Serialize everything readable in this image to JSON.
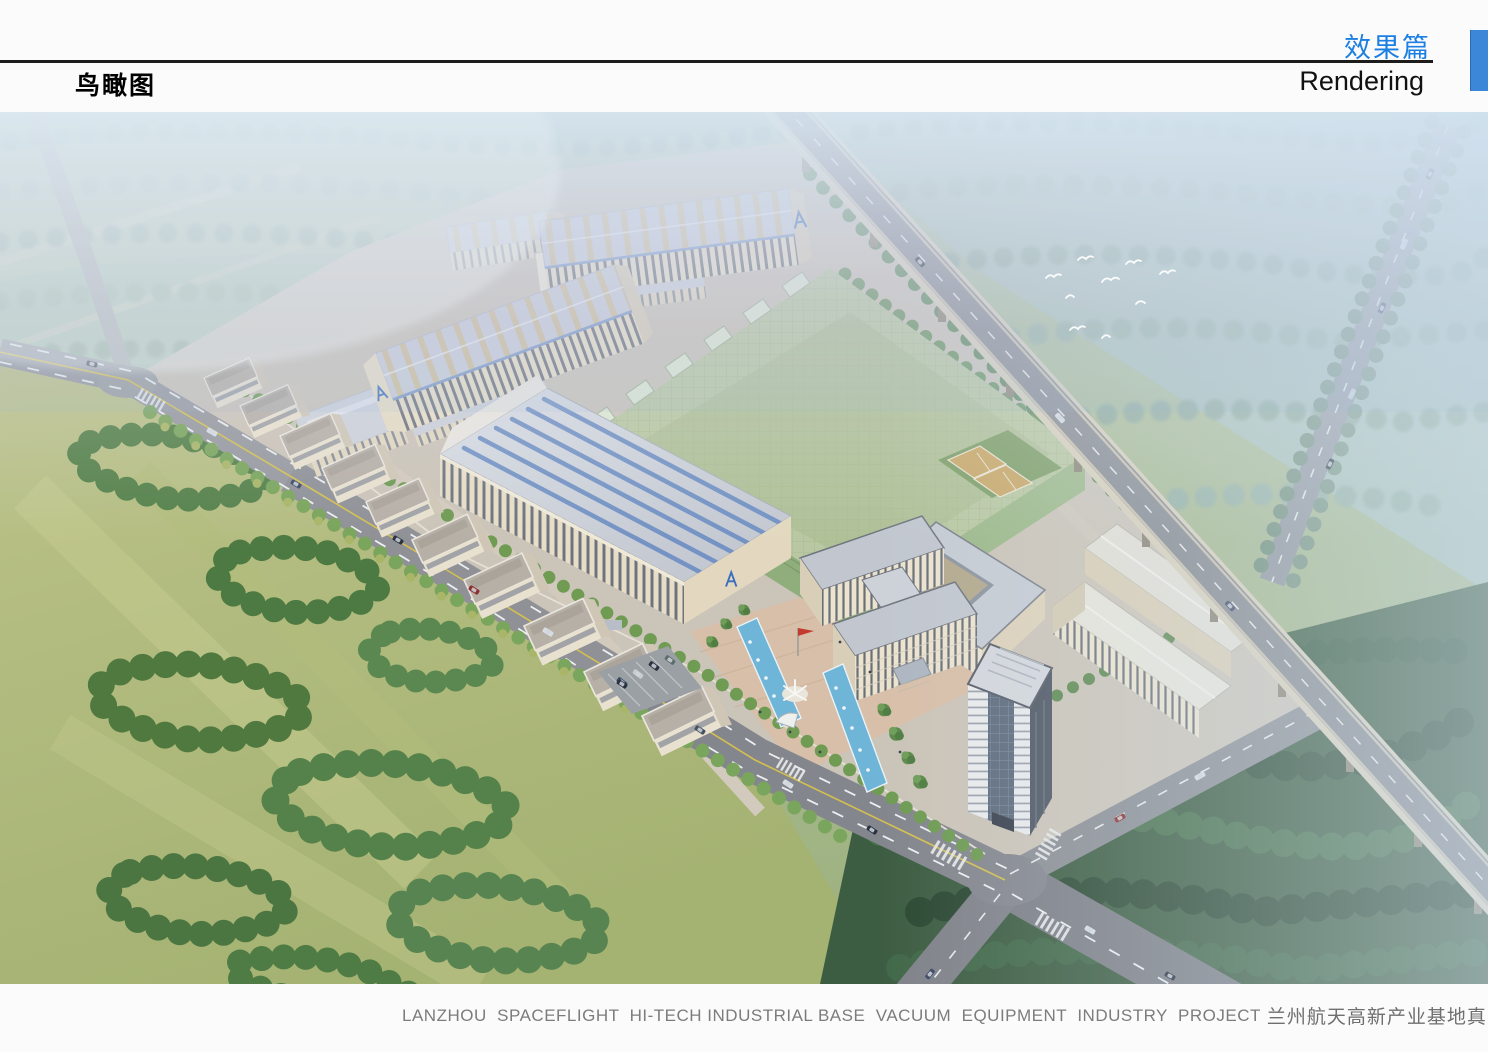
{
  "header": {
    "page_title": "鸟瞰图",
    "section_title_cn": "效果篇",
    "section_title_en": "Rendering",
    "accent_color": "#1c7fe3",
    "tab_color": "#3d87d8"
  },
  "rendering": {
    "alt": "Aerial bird's-eye rendering of an industrial park: long factory halls with skylight roofs, a green glass workshop, an office building with plaza and fountain pools, a high-rise tower, tree-lined roads, fields and an elevated expressway crossing diagonally"
  },
  "footer": {
    "caption_en": "LANZHOU  SPACEFLIGHT  HI-TECH INDUSTRIAL BASE  VACUUM  EQUIPMENT  INDUSTRY  PROJECT",
    "caption_cn": "兰州航天高新产业基地真空装备产业园项目",
    "text_color": "#7c7c7c",
    "square_color": "#4a99e0"
  }
}
